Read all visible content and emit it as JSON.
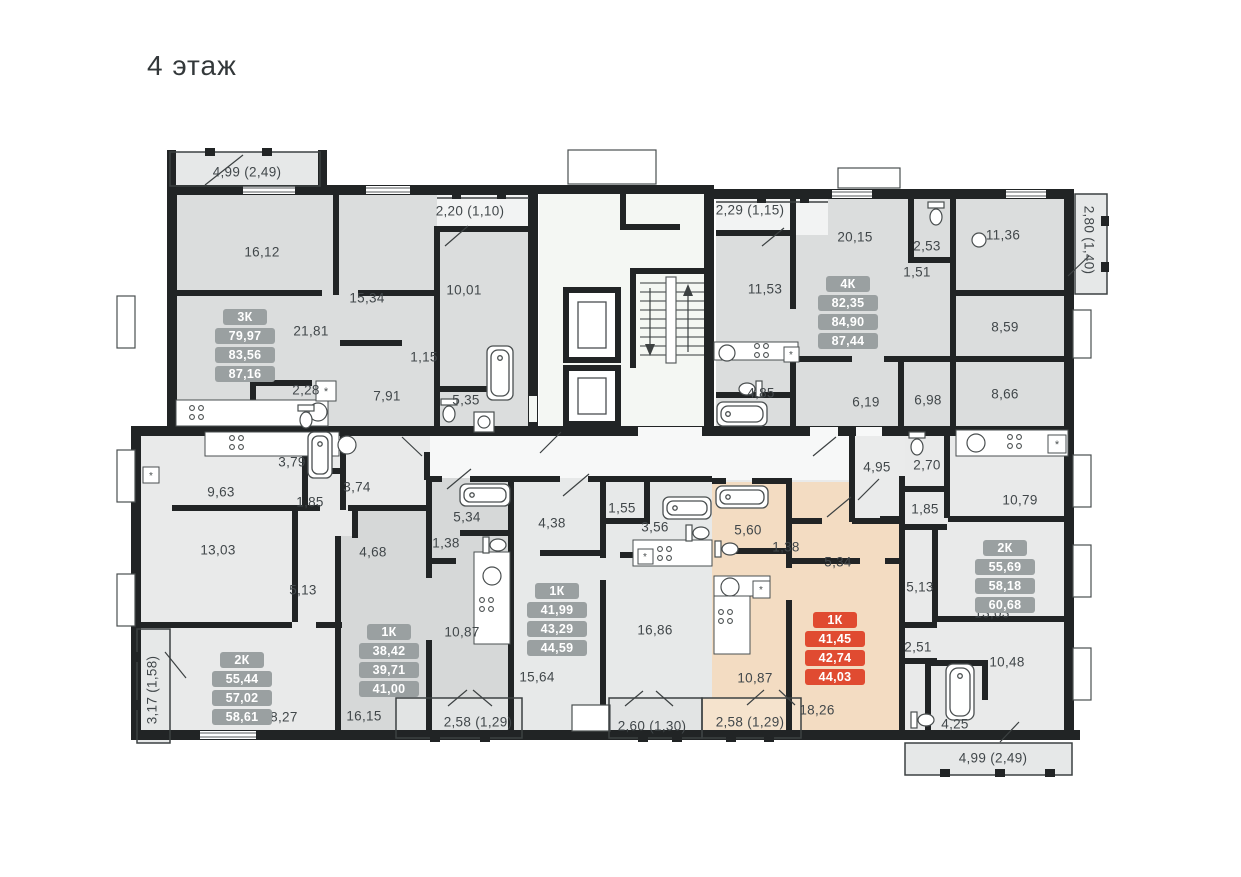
{
  "title": "4 этаж",
  "colors": {
    "wall": "#212425",
    "badge_gray": "#9aa0a1",
    "badge_red": "#e04b31",
    "highlight_apartment": "#f3dcc2",
    "room_gray": "#dbdddd",
    "label_text": "#41474a"
  },
  "apartments": [
    {
      "type": "3К",
      "areas": [
        "79,97",
        "83,56",
        "87,16"
      ],
      "badge": "gray",
      "cx": 246,
      "top": 309
    },
    {
      "type": "4К",
      "areas": [
        "82,35",
        "84,90",
        "87,44"
      ],
      "badge": "gray",
      "cx": 849,
      "top": 276
    },
    {
      "type": "2К",
      "areas": [
        "55,44",
        "57,02",
        "58,61"
      ],
      "badge": "gray",
      "cx": 243,
      "top": 652
    },
    {
      "type": "1К",
      "areas": [
        "38,42",
        "39,71",
        "41,00"
      ],
      "badge": "gray",
      "cx": 390,
      "top": 624
    },
    {
      "type": "1К",
      "areas": [
        "41,99",
        "43,29",
        "44,59"
      ],
      "badge": "gray",
      "cx": 558,
      "top": 583
    },
    {
      "type": "1К",
      "areas": [
        "41,45",
        "42,74",
        "44,03"
      ],
      "badge": "red",
      "cx": 836,
      "top": 612
    },
    {
      "type": "2К",
      "areas": [
        "55,69",
        "58,18",
        "60,68"
      ],
      "badge": "gray",
      "cx": 1006,
      "top": 540
    }
  ],
  "labels": [
    {
      "t": "4,99 (2,49)",
      "x": 247,
      "y": 172
    },
    {
      "t": "16,12",
      "x": 262,
      "y": 252
    },
    {
      "t": "15,34",
      "x": 367,
      "y": 298
    },
    {
      "t": "2,20 (1,10)",
      "x": 470,
      "y": 211
    },
    {
      "t": "10,01",
      "x": 464,
      "y": 290
    },
    {
      "t": "21,81",
      "x": 311,
      "y": 331
    },
    {
      "t": "1,15",
      "x": 424,
      "y": 357
    },
    {
      "t": "2,28",
      "x": 306,
      "y": 390
    },
    {
      "t": "7,91",
      "x": 387,
      "y": 396
    },
    {
      "t": "5,35",
      "x": 466,
      "y": 400
    },
    {
      "t": "2,29 (1,15)",
      "x": 750,
      "y": 210
    },
    {
      "t": "20,15",
      "x": 855,
      "y": 237
    },
    {
      "t": "2,53",
      "x": 927,
      "y": 246
    },
    {
      "t": "1,51",
      "x": 917,
      "y": 272
    },
    {
      "t": "11,36",
      "x": 1003,
      "y": 235
    },
    {
      "t": "11,53",
      "x": 765,
      "y": 289
    },
    {
      "t": "8,59",
      "x": 1005,
      "y": 327
    },
    {
      "t": "4,85",
      "x": 761,
      "y": 393
    },
    {
      "t": "6,19",
      "x": 866,
      "y": 402
    },
    {
      "t": "6,98",
      "x": 928,
      "y": 400
    },
    {
      "t": "8,66",
      "x": 1005,
      "y": 394
    },
    {
      "t": "2,80 (1,40)",
      "x": 1089,
      "y": 240,
      "r": 90
    },
    {
      "t": "9,63",
      "x": 221,
      "y": 492
    },
    {
      "t": "3,79",
      "x": 292,
      "y": 462
    },
    {
      "t": "3,74",
      "x": 357,
      "y": 487
    },
    {
      "t": "1,85",
      "x": 310,
      "y": 502
    },
    {
      "t": "13,03",
      "x": 218,
      "y": 550
    },
    {
      "t": "5,13",
      "x": 303,
      "y": 590
    },
    {
      "t": "18,27",
      "x": 280,
      "y": 717
    },
    {
      "t": "3,17 (1,58)",
      "x": 152,
      "y": 690,
      "r": -90
    },
    {
      "t": "4,68",
      "x": 373,
      "y": 552
    },
    {
      "t": "1,38",
      "x": 446,
      "y": 543
    },
    {
      "t": "5,34",
      "x": 467,
      "y": 517
    },
    {
      "t": "10,87",
      "x": 462,
      "y": 632
    },
    {
      "t": "16,15",
      "x": 364,
      "y": 716
    },
    {
      "t": "4,38",
      "x": 552,
      "y": 523
    },
    {
      "t": "1,55",
      "x": 622,
      "y": 508
    },
    {
      "t": "3,56",
      "x": 655,
      "y": 527
    },
    {
      "t": "15,64",
      "x": 537,
      "y": 677
    },
    {
      "t": "16,86",
      "x": 655,
      "y": 630
    },
    {
      "t": "2,58 (1,29)",
      "x": 478,
      "y": 722
    },
    {
      "t": "2,60 (1,30)",
      "x": 652,
      "y": 726
    },
    {
      "t": "5,60",
      "x": 748,
      "y": 530
    },
    {
      "t": "1,38",
      "x": 786,
      "y": 547
    },
    {
      "t": "5,34",
      "x": 838,
      "y": 562
    },
    {
      "t": "10,87",
      "x": 755,
      "y": 678
    },
    {
      "t": "18,26",
      "x": 817,
      "y": 710
    },
    {
      "t": "2,58 (1,29)",
      "x": 750,
      "y": 722
    },
    {
      "t": "4,95",
      "x": 877,
      "y": 467
    },
    {
      "t": "2,70",
      "x": 927,
      "y": 465
    },
    {
      "t": "1,85",
      "x": 925,
      "y": 509
    },
    {
      "t": "5,13",
      "x": 920,
      "y": 587
    },
    {
      "t": "2,51",
      "x": 918,
      "y": 647
    },
    {
      "t": "10,79",
      "x": 1020,
      "y": 500
    },
    {
      "t": "13,03",
      "x": 992,
      "y": 613
    },
    {
      "t": "10,48",
      "x": 1007,
      "y": 662
    },
    {
      "t": "4,25",
      "x": 955,
      "y": 724
    },
    {
      "t": "4,99 (2,49)",
      "x": 993,
      "y": 758
    }
  ]
}
